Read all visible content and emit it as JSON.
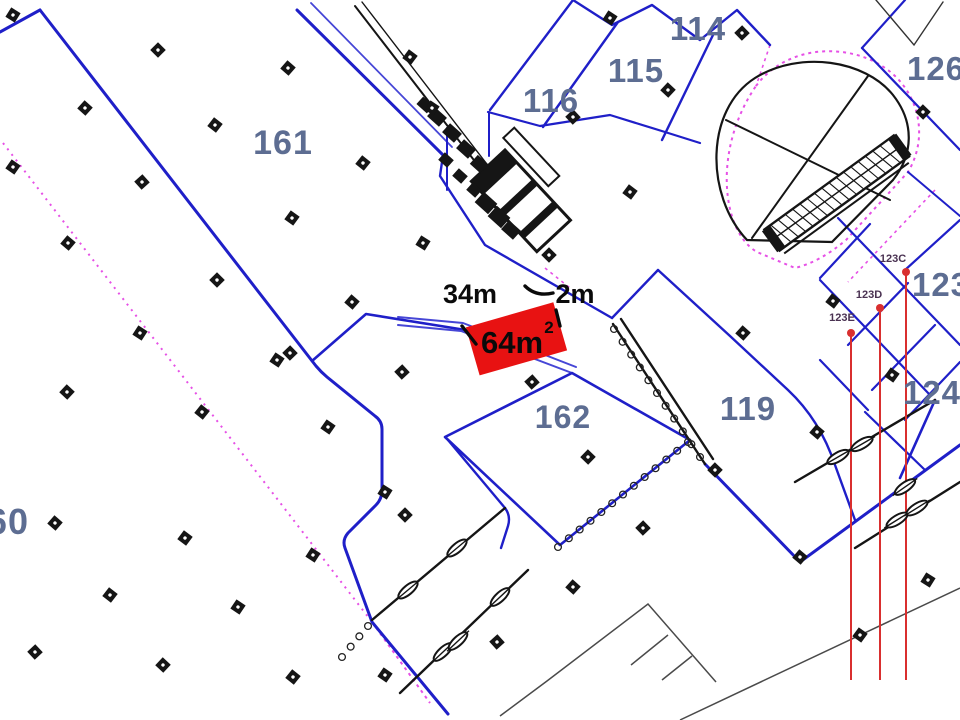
{
  "rooms": [
    {
      "id": "161",
      "label": "161"
    },
    {
      "id": "116",
      "label": "116"
    },
    {
      "id": "115",
      "label": "115"
    },
    {
      "id": "114",
      "label": "114"
    },
    {
      "id": "126",
      "label": "126"
    },
    {
      "id": "123",
      "label": "123"
    },
    {
      "id": "124",
      "label": "124"
    },
    {
      "id": "119",
      "label": "119"
    },
    {
      "id": "162",
      "label": "162"
    },
    {
      "id": "60",
      "label": "60"
    }
  ],
  "dims": {
    "width": "34m",
    "clearance": "2m",
    "area": "64m",
    "area_sup": "2"
  },
  "stalls": [
    {
      "label": "123C"
    },
    {
      "label": "123D"
    },
    {
      "label": "123E"
    }
  ],
  "colors": {
    "wall_blue": "#1f1fc8",
    "partition_blue": "#4646d6",
    "survey_magenta": "#e650e6",
    "highlight_red": "#e81212",
    "leader_red": "#d92f2f",
    "annotation_black": "#0a0a0a",
    "label_slate": "#5d6d92",
    "detail_black": "#151515",
    "thin_gray": "#4a4a4a"
  }
}
